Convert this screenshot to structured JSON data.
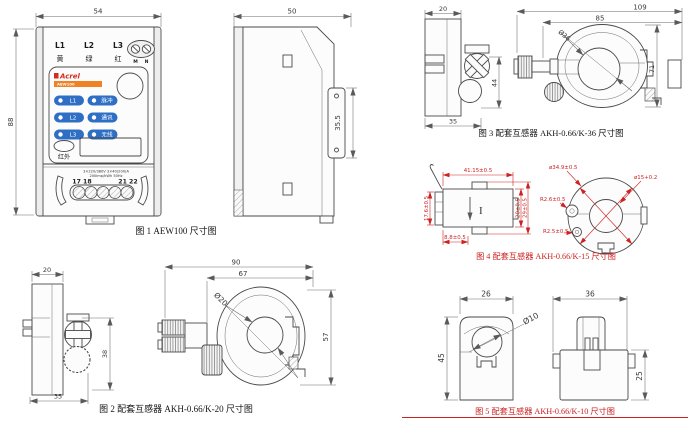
{
  "palette": {
    "line": "#4a4a4a",
    "red": "#cc2222",
    "led_blue": "#2e6fc5",
    "brand_red": "#d52b1e",
    "brand_orange": "#f08125"
  },
  "fig1": {
    "caption": "图 1 AEW100 尺寸图",
    "dims": {
      "width": "54",
      "height": "88"
    },
    "phases": [
      "L1",
      "L2",
      "L3"
    ],
    "phase_colors": [
      "黄",
      "绿",
      "红"
    ],
    "neutral_labels": [
      "M",
      "N"
    ],
    "brand": "Acrel",
    "model": "AEW100",
    "led_rows": [
      {
        "left": "L1",
        "right": "脉冲"
      },
      {
        "left": "L2",
        "right": "通讯"
      },
      {
        "left": "L3",
        "right": "无线"
      }
    ],
    "infrared": "红外",
    "spec_line1": "3×220/380V 3×40(200)A",
    "spec_line2": "200imp/kWh 50Hz",
    "terminals_left": "17 18",
    "terminals_right": "21 22"
  },
  "fig1_side": {
    "dims": {
      "width": "50",
      "rail": "35.5"
    }
  },
  "fig2": {
    "caption": "图 2 配套互感器 AKH-0.66/K-20 尺寸图",
    "side": {
      "width": "20",
      "height": "38",
      "base": "35"
    },
    "front": {
      "outer_width": "90",
      "inner_width": "67",
      "hole": "Ø20",
      "height": "57"
    }
  },
  "fig3": {
    "caption": "图 3 配套互感器 AKH-0.66/K-36 尺寸图",
    "side": {
      "width": "20",
      "height": "44",
      "base": "35"
    },
    "front": {
      "outer_width": "109",
      "inner_width": "85",
      "hole": "Ø36",
      "height": "71"
    }
  },
  "fig4": {
    "caption": "图 4 配套互感器 AKH-0.66/K-15 尺寸图",
    "left": {
      "top": "41.15±0.5",
      "side": "17.6±0.5",
      "inner_height": "20±0.5",
      "outer_height": "29±0.5",
      "bottom": "8.8±0.5",
      "current_mark": "I"
    },
    "right": {
      "outer_dia": "ø34.9±0.5",
      "hole_dia": "ø15+0.2",
      "radius1": "R2.6±0.5",
      "radius2": "R2.5±0.5"
    }
  },
  "fig5": {
    "caption": "图 5 配套互感器 AKH-0.66/K-10 尺寸图",
    "left": {
      "width": "26",
      "height": "45",
      "hole": "Ø10"
    },
    "right": {
      "width": "36",
      "height": "25"
    }
  }
}
